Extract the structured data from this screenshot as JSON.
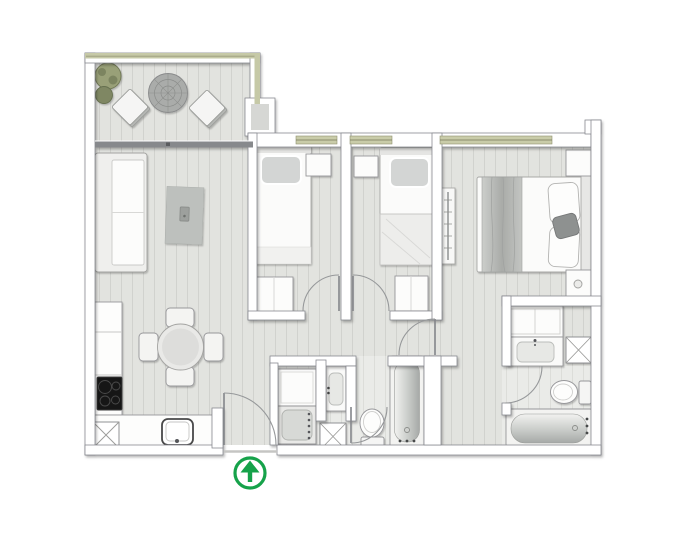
{
  "colors": {
    "page_background": "#ffffff",
    "floor": "#e2e3df",
    "floor_line": "#d1d2ce",
    "floor_bath": "#eaebe8",
    "floor_bath_line": "#dcddd9",
    "wall_fill": "#ffffff",
    "wall_outline": "#82848a",
    "balcony_trim": "#c6c9a7",
    "window_sill": "#c9cca9",
    "sill_line": "#74775a",
    "divider_bar": "#87898c",
    "rug": "#bdc0bd",
    "bush_large": "#99a078",
    "bush_small": "#7f8763",
    "cooktop_black": "#191919",
    "fixture_outline": "#97979a",
    "furniture_fill": "#fbfbfa",
    "tub_deep": "#a6a9a7",
    "accent_green": "#16a24a",
    "arc_line": "#96989a"
  },
  "icons": {
    "entrance_arrow": "circled-arrow-up"
  }
}
